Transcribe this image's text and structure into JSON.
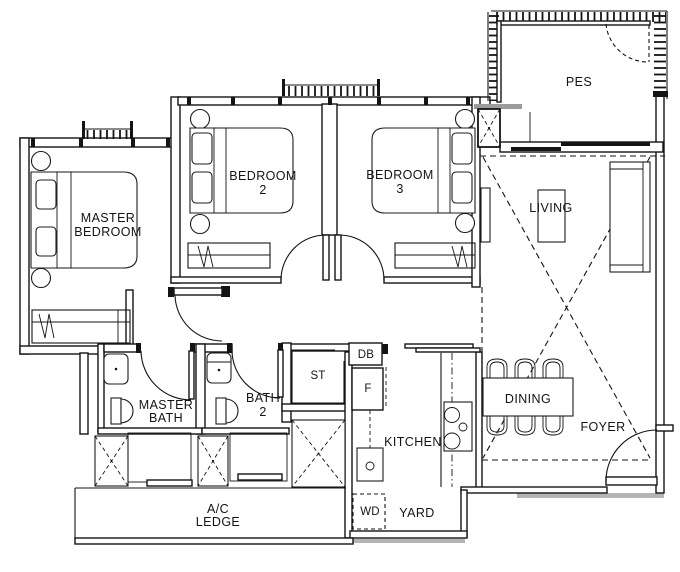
{
  "page": {
    "background": "#ffffff",
    "line_color": "#141414",
    "shadow_color": "#b5b5b5",
    "highlight_color": "#9c9c9c"
  },
  "rooms": {
    "master_bedroom": {
      "lines": [
        "MASTER",
        "BEDROOM"
      ]
    },
    "bedroom_2": {
      "lines": [
        "BEDROOM",
        "2"
      ]
    },
    "bedroom_3": {
      "lines": [
        "BEDROOM",
        "3"
      ]
    },
    "master_bath": {
      "lines": [
        "MASTER",
        "BATH"
      ]
    },
    "bath_2": {
      "lines": [
        "BATH",
        "2"
      ]
    },
    "ac_ledge": {
      "lines": [
        "A/C",
        "LEDGE"
      ]
    },
    "pes": {
      "label": "PES"
    },
    "living": {
      "label": "LIVING"
    },
    "dining": {
      "label": "DINING"
    },
    "foyer": {
      "label": "FOYER"
    },
    "kitchen": {
      "label": "KITCHEN"
    },
    "yard": {
      "label": "YARD"
    },
    "store": {
      "label": "ST"
    },
    "db": {
      "label": "DB"
    },
    "fridge": {
      "label": "F"
    },
    "washer_dryer": {
      "label": "WD"
    }
  }
}
